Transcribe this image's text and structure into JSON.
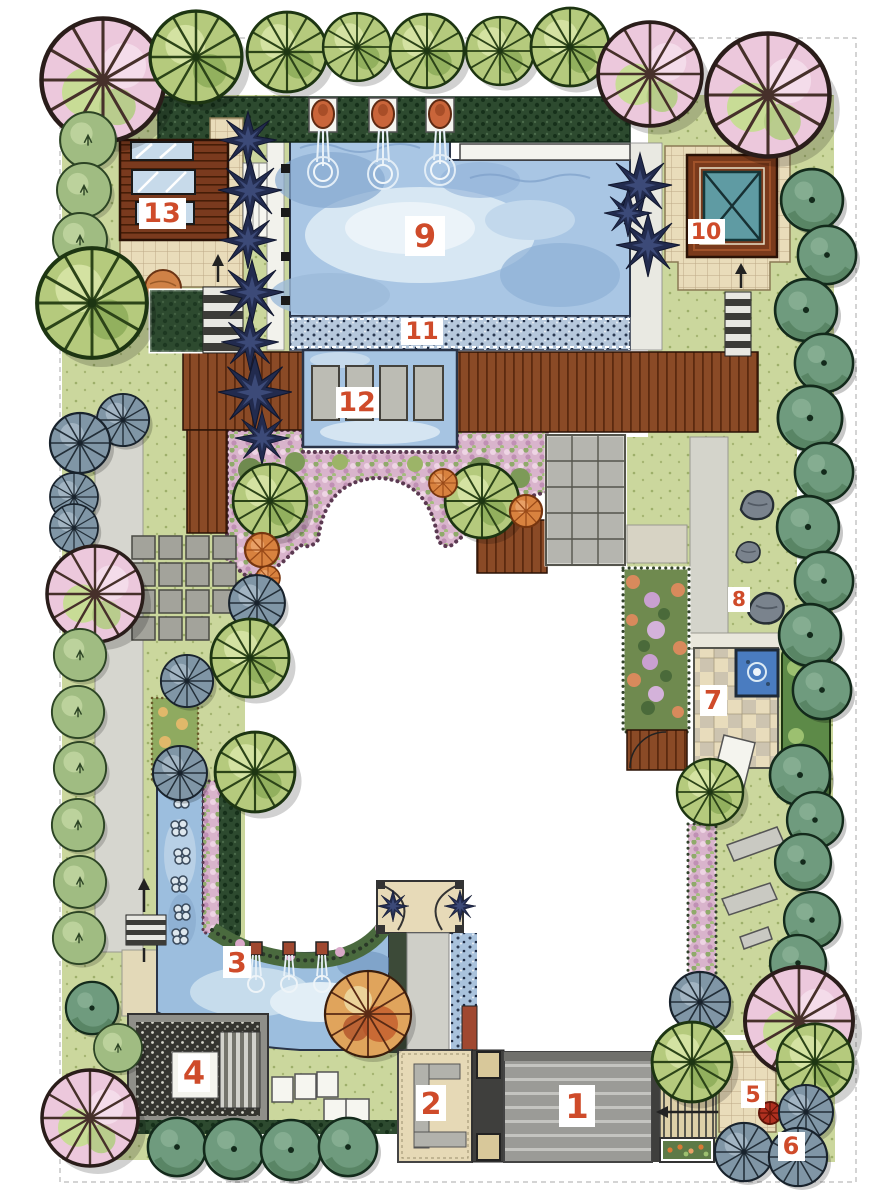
{
  "canvas": {
    "width": 886,
    "height": 1200,
    "background": "#ffffff"
  },
  "plan": {
    "type": "residential-garden-landscape-plan",
    "labels": [
      {
        "num": "1",
        "x": 577,
        "y": 1106
      },
      {
        "num": "2",
        "x": 431,
        "y": 1103
      },
      {
        "num": "3",
        "x": 237,
        "y": 962
      },
      {
        "num": "4",
        "x": 194,
        "y": 1073
      },
      {
        "num": "5",
        "x": 753,
        "y": 1094
      },
      {
        "num": "6",
        "x": 791,
        "y": 1146
      },
      {
        "num": "7",
        "x": 713,
        "y": 700
      },
      {
        "num": "8",
        "x": 739,
        "y": 599
      },
      {
        "num": "9",
        "x": 425,
        "y": 236
      },
      {
        "num": "10",
        "x": 706,
        "y": 231
      },
      {
        "num": "11",
        "x": 422,
        "y": 331
      },
      {
        "num": "12",
        "x": 357,
        "y": 402
      },
      {
        "num": "13",
        "x": 162,
        "y": 213
      }
    ],
    "label_style": {
      "number_color": "#cf4b2a",
      "box_color": "#ffffff"
    },
    "palette": {
      "lawn": "#cbd79d",
      "water": "#a9c6e4",
      "water_light": "#d7e7f3",
      "deck_wood": "#8a4a26",
      "building_wood": "#7a3a1e",
      "pavilion_roof": "#5f9ba3",
      "paving_tan": "#e9dcba",
      "paving_gray": "#a6a6a0",
      "driveway_gray": "#9b9b97",
      "hedge_dark_green": "#2d4a2f",
      "flower_pink": "#d9b4cc",
      "shrub_orange": "#d8823f",
      "spiky_plant_navy": "#222b4e",
      "tree_green": "#b5ca7d",
      "tree_sea_green": "#6f9b7e",
      "tree_blue_gray": "#8096a6",
      "tree_pink": "#ecc8dc"
    }
  }
}
